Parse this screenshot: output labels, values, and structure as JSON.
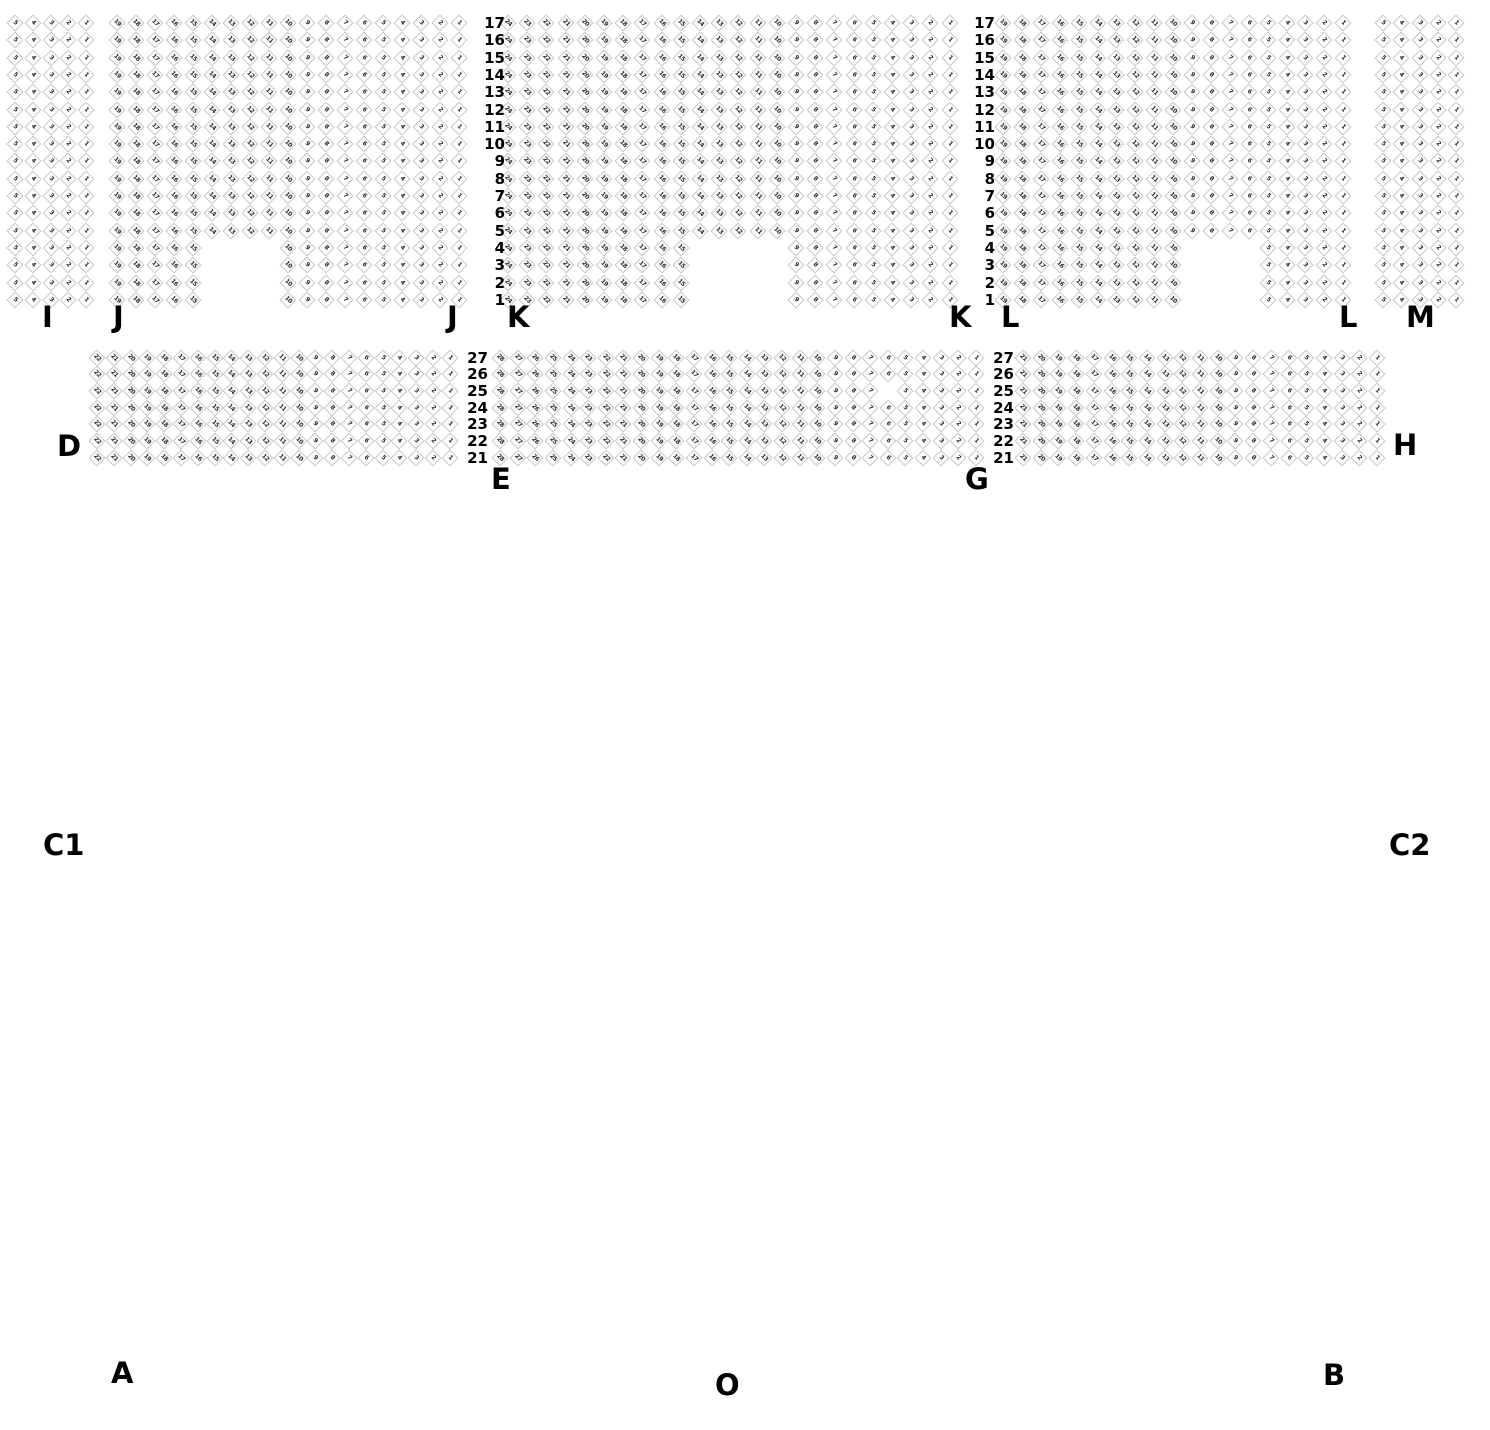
{
  "canvas": {
    "width": 1490,
    "height": 1430,
    "background": "#ffffff"
  },
  "style": {
    "seat_border_color": "#c6c6c6",
    "seat_number_color": "#2b2b2b",
    "label_color": "#000000"
  },
  "seat_sections": [
    {
      "name": "I",
      "rows": 17,
      "cols": 5,
      "x": 15,
      "y": 23,
      "dx": 17.75,
      "dy": 17.3
    },
    {
      "name": "J",
      "rows": 17,
      "cols": 19,
      "x": 117,
      "y": 23,
      "dx": 19.0,
      "dy": 17.3,
      "notch": {
        "bottom_rows": 4,
        "col_start": 6,
        "col_end": 9
      }
    },
    {
      "name": "K",
      "rows": 17,
      "cols": 24,
      "x": 508,
      "y": 23,
      "dx": 19.2,
      "dy": 17.3,
      "notch": {
        "bottom_rows": 4,
        "col_start": 11,
        "col_end": 15
      }
    },
    {
      "name": "L",
      "rows": 17,
      "cols": 19,
      "x": 1003,
      "y": 23,
      "dx": 18.9,
      "dy": 17.3,
      "notch": {
        "bottom_rows": 4,
        "col_start": 11,
        "col_end": 14
      }
    },
    {
      "name": "M",
      "rows": 17,
      "cols": 5,
      "x": 1383,
      "y": 23,
      "dx": 18.3,
      "dy": 17.3
    },
    {
      "name": "D",
      "rows": 7,
      "cols": 22,
      "x": 97,
      "y": 357.5,
      "dx": 16.8,
      "dy": 16.7
    },
    {
      "name": "E",
      "rows": 7,
      "cols": 28,
      "x": 500,
      "y": 357.5,
      "dx": 17.63,
      "dy": 16.7,
      "missing_seats": [
        {
          "row_from_top": 3,
          "col": 23
        }
      ]
    },
    {
      "name": "G",
      "rows": 7,
      "cols": 21,
      "x": 1023,
      "y": 357.5,
      "dx": 17.7,
      "dy": 16.7
    }
  ],
  "row_number_columns": [
    {
      "x_right": 505,
      "y": 23,
      "dy": 17.3,
      "numbers": [
        "17",
        "16",
        "15",
        "14",
        "13",
        "12",
        "11",
        "10",
        "9",
        "8",
        "7",
        "6",
        "5",
        "4",
        "3",
        "2",
        "1"
      ]
    },
    {
      "x_right": 995,
      "y": 23,
      "dy": 17.3,
      "numbers": [
        "17",
        "16",
        "15",
        "14",
        "13",
        "12",
        "11",
        "10",
        "9",
        "8",
        "7",
        "6",
        "5",
        "4",
        "3",
        "2",
        "1"
      ]
    },
    {
      "x_right": 488,
      "y": 357.5,
      "dy": 16.7,
      "numbers": [
        "27",
        "26",
        "25",
        "24",
        "23",
        "22",
        "21"
      ]
    },
    {
      "x_right": 1014,
      "y": 357.5,
      "dy": 16.7,
      "numbers": [
        "27",
        "26",
        "25",
        "24",
        "23",
        "22",
        "21"
      ]
    }
  ],
  "section_labels": [
    {
      "text": "I",
      "x": 42,
      "y": 303
    },
    {
      "text": "J",
      "x": 113,
      "y": 303
    },
    {
      "text": "J",
      "x": 447,
      "y": 303
    },
    {
      "text": "K",
      "x": 507,
      "y": 303
    },
    {
      "text": "K",
      "x": 949,
      "y": 303
    },
    {
      "text": "L",
      "x": 1001,
      "y": 303
    },
    {
      "text": "L",
      "x": 1339,
      "y": 303
    },
    {
      "text": "M",
      "x": 1406,
      "y": 303
    },
    {
      "text": "D",
      "x": 57,
      "y": 432
    },
    {
      "text": "E",
      "x": 491,
      "y": 465
    },
    {
      "text": "G",
      "x": 965,
      "y": 465
    },
    {
      "text": "H",
      "x": 1393,
      "y": 431
    },
    {
      "text": "C1",
      "x": 43,
      "y": 831
    },
    {
      "text": "C2",
      "x": 1389,
      "y": 831
    },
    {
      "text": "A",
      "x": 111,
      "y": 1359
    },
    {
      "text": "B",
      "x": 1323,
      "y": 1361
    },
    {
      "text": "O",
      "x": 715,
      "y": 1371
    }
  ]
}
